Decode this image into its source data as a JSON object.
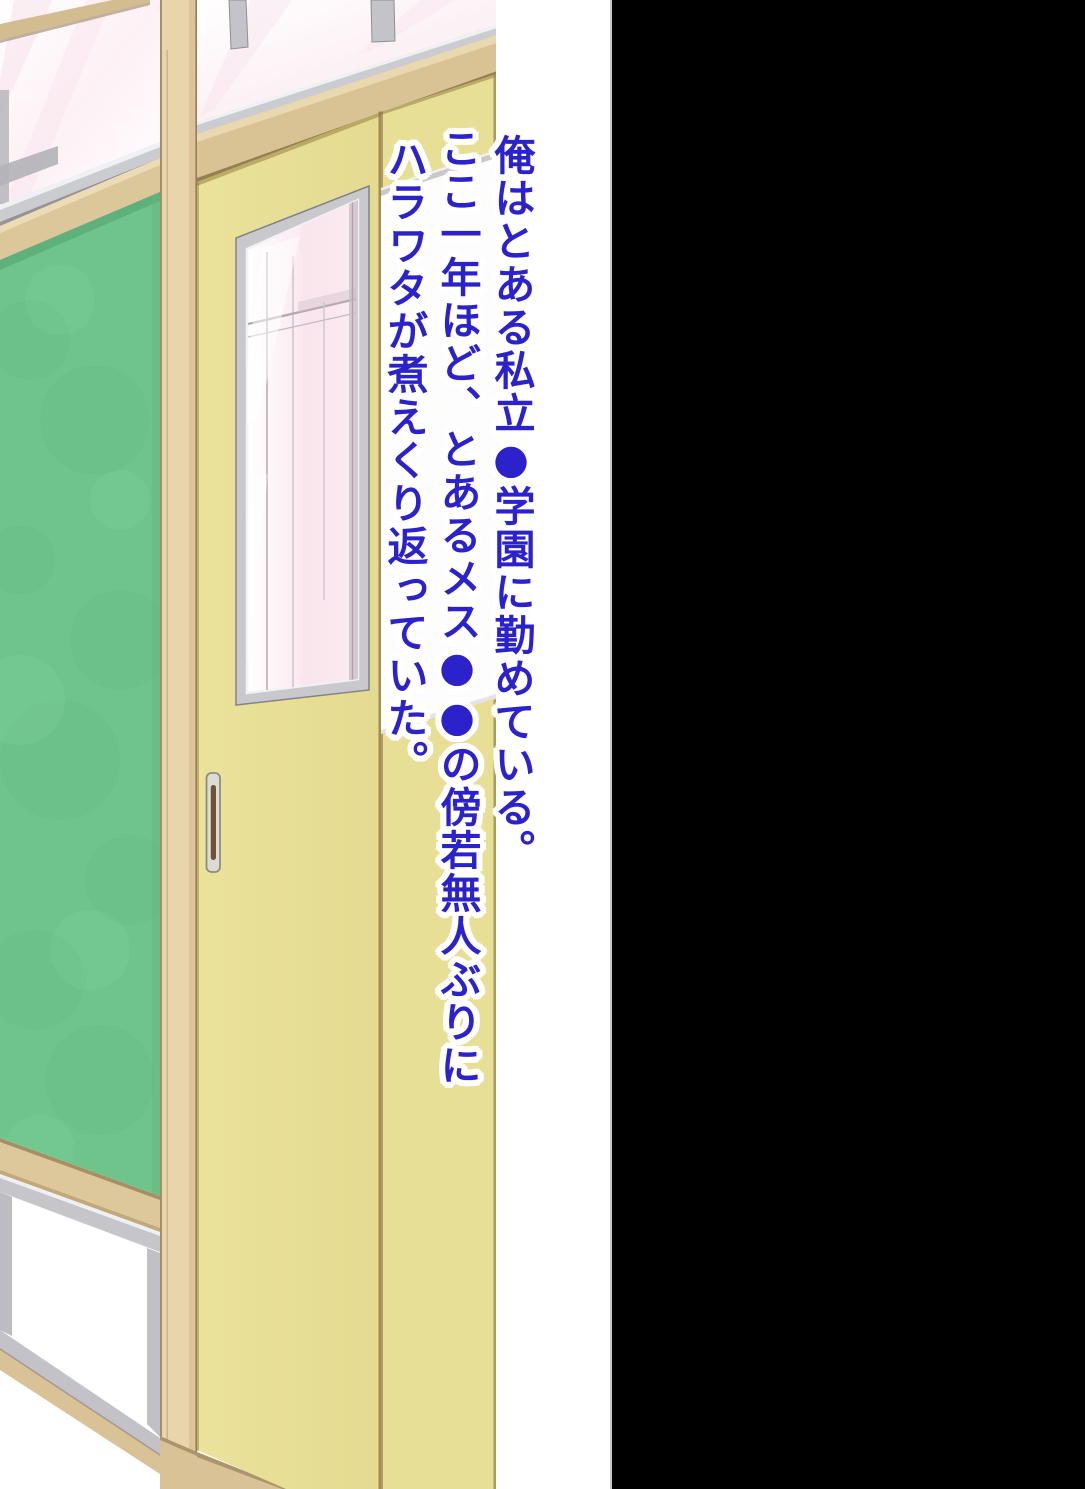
{
  "narration": {
    "line1": "俺はとある私立●学園に勤めている。",
    "line2": "ここ一年ほど、とあるメス●●の傍若無人ぶりに",
    "line3": "ハラワタが煮えくり返っていた。",
    "text_color": "#2b22cc",
    "outline_color": "#ffffff"
  },
  "scene": {
    "colors": {
      "door_yellow": "#e6dd9c",
      "wall_green": "#6fc48c",
      "wood_tan": "#d9c394",
      "window_frame_gray": "#c9c9cd",
      "hallway_pink": "#fbe7ee",
      "background_white": "#ffffff",
      "letterbox_black": "#000000"
    }
  }
}
